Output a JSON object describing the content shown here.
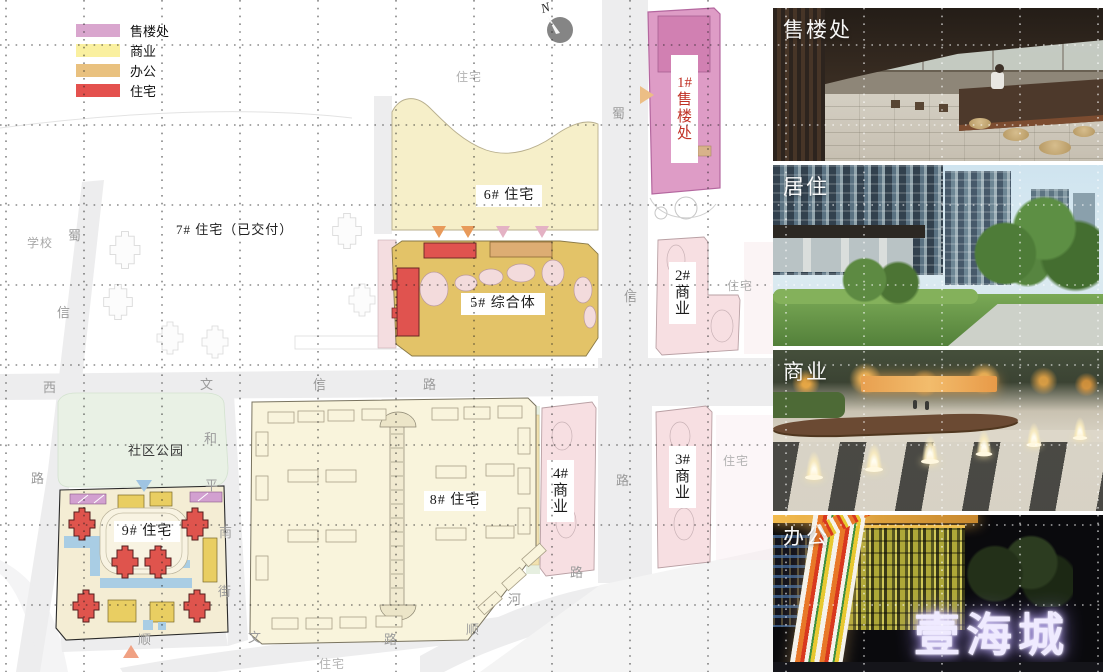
{
  "legend": {
    "items": [
      {
        "label": "售楼处",
        "color": "#d9a6ce"
      },
      {
        "label": "商业",
        "color": "#faf0a0"
      },
      {
        "label": "办公",
        "color": "#e9c17f"
      },
      {
        "label": "住宅",
        "color": "#e4514e"
      }
    ]
  },
  "compass": {
    "label": "N"
  },
  "map": {
    "chips": [
      {
        "name": "label-6-residential",
        "lines": [
          "6# 住宅"
        ],
        "x": 476,
        "y": 185,
        "w": 66,
        "h": 22,
        "vertical": false,
        "color": "#1a1a1a"
      },
      {
        "name": "label-5-complex",
        "lines": [
          "5# 综合体"
        ],
        "x": 461,
        "y": 293,
        "w": 84,
        "h": 22,
        "vertical": false,
        "color": "#1a1a1a"
      },
      {
        "name": "label-8-residential",
        "lines": [
          "8# 住宅"
        ],
        "x": 424,
        "y": 491,
        "w": 62,
        "h": 20,
        "vertical": false,
        "color": "#1a1a1a"
      },
      {
        "name": "label-9-residential",
        "lines": [
          "9# 住宅"
        ],
        "x": 114,
        "y": 521,
        "w": 66,
        "h": 21,
        "vertical": false,
        "color": "#1a1a1a"
      },
      {
        "name": "label-1-sales",
        "lines": [
          "1#",
          "售",
          "楼",
          "处"
        ],
        "x": 671,
        "y": 55,
        "w": 27,
        "h": 108,
        "vertical": true,
        "color": "#c03226"
      },
      {
        "name": "label-2-commercial",
        "lines": [
          "2#",
          "商",
          "业"
        ],
        "x": 669,
        "y": 262,
        "w": 27,
        "h": 62,
        "vertical": true,
        "color": "#1a1a1a"
      },
      {
        "name": "label-3-commercial",
        "lines": [
          "3#",
          "商",
          "业"
        ],
        "x": 669,
        "y": 446,
        "w": 27,
        "h": 62,
        "vertical": true,
        "color": "#1a1a1a"
      },
      {
        "name": "label-4-commercial",
        "lines": [
          "4#",
          "商",
          "业"
        ],
        "x": 547,
        "y": 460,
        "w": 27,
        "h": 62,
        "vertical": true,
        "color": "#1a1a1a"
      }
    ],
    "plain_labels": [
      {
        "text": "7# 住宅（已交付）",
        "x": 176,
        "y": 219,
        "size": 13,
        "color": "#222222"
      },
      {
        "text": "社区公园",
        "x": 128,
        "y": 440,
        "size": 13,
        "color": "#3a3a3a"
      },
      {
        "text": "学校",
        "x": 27,
        "y": 234,
        "size": 12,
        "color": "#a8a8a8"
      },
      {
        "text": "住宅",
        "x": 456,
        "y": 68,
        "size": 12,
        "color": "#b3b3b3"
      },
      {
        "text": "住宅",
        "x": 727,
        "y": 277,
        "size": 12,
        "color": "#b3b3b3"
      },
      {
        "text": "住宅",
        "x": 723,
        "y": 452,
        "size": 12,
        "color": "#b3b3b3"
      },
      {
        "text": "住宅",
        "x": 319,
        "y": 655,
        "size": 12,
        "color": "#b3b3b3"
      }
    ],
    "street_chars": [
      {
        "ch": "蜀",
        "x": 68,
        "y": 225
      },
      {
        "ch": "信",
        "x": 57,
        "y": 302
      },
      {
        "ch": "西",
        "x": 43,
        "y": 377
      },
      {
        "ch": "文",
        "x": 200,
        "y": 374
      },
      {
        "ch": "信",
        "x": 313,
        "y": 374
      },
      {
        "ch": "路",
        "x": 423,
        "y": 374
      },
      {
        "ch": "路",
        "x": 31,
        "y": 468
      },
      {
        "ch": "和",
        "x": 204,
        "y": 428
      },
      {
        "ch": "平",
        "x": 205,
        "y": 475
      },
      {
        "ch": "南",
        "x": 219,
        "y": 522
      },
      {
        "ch": "街",
        "x": 218,
        "y": 581
      },
      {
        "ch": "顺",
        "x": 138,
        "y": 629
      },
      {
        "ch": "文",
        "x": 248,
        "y": 627
      },
      {
        "ch": "路",
        "x": 384,
        "y": 629
      },
      {
        "ch": "顺",
        "x": 466,
        "y": 619
      },
      {
        "ch": "河",
        "x": 508,
        "y": 589
      },
      {
        "ch": "蜀",
        "x": 612,
        "y": 103
      },
      {
        "ch": "信",
        "x": 624,
        "y": 286
      },
      {
        "ch": "路",
        "x": 616,
        "y": 470
      },
      {
        "ch": "路",
        "x": 570,
        "y": 562
      }
    ]
  },
  "photos": [
    {
      "caption": "售楼处"
    },
    {
      "caption": "居住"
    },
    {
      "caption": "商业"
    },
    {
      "caption": "办公",
      "sign_text": "壹海城"
    }
  ]
}
